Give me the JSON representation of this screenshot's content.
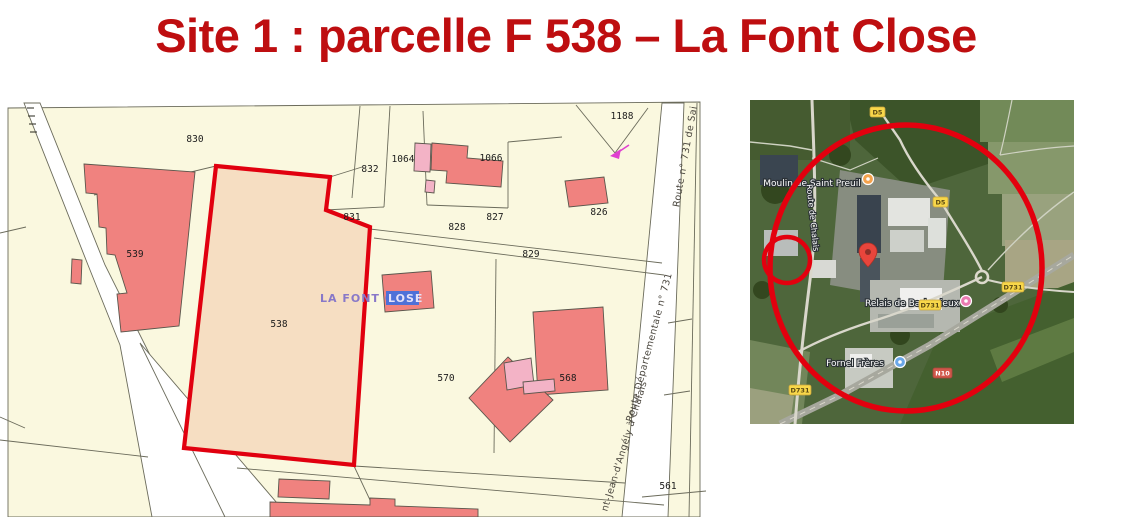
{
  "title": "Site 1 : parcelle F 538 – La Font Close",
  "cadastral_map": {
    "locality_label_part1": "LA FONT C",
    "locality_label_part2": "LOSE",
    "parcel_numbers": {
      "p830": "830",
      "p832": "832",
      "p1064": "1064",
      "p1066": "1066",
      "p1188": "1188",
      "p827": "827",
      "p828": "828",
      "p829": "829",
      "p826": "826",
      "p831": "831",
      "p539": "539",
      "p538": "538",
      "p570": "570",
      "p568": "568",
      "p561": "561"
    },
    "road_names": {
      "route_731_top": "Route n° 731 de Sai",
      "route_departementale": "Route Départementale n° 731",
      "route_jean_angely": "nt-Jean-d'Angély à Chalais"
    },
    "colors": {
      "map_background": "#FAF8DF",
      "building_fill": "#F0827F",
      "building_light_fill": "#F3B3C6",
      "highlight_parcel_fill": "#F6DEC2",
      "highlight_parcel_border": "#E1000F",
      "parcel_line": "#6B6B5B"
    }
  },
  "satellite_map": {
    "place_labels": {
      "moulin": "Moulin de Saint Preuil",
      "relais": "Relais de Barbezieux",
      "fornel": "Fornel Frères",
      "route_chalais": "Route de Chalais"
    },
    "route_badges": {
      "d5_top": "D5",
      "d5_mid": "D5",
      "d731_right": "D731",
      "d731_mid": "D731",
      "d731_left": "D731",
      "n10": "N10"
    },
    "colors": {
      "annotation_red": "#E3000E",
      "badge_yellow": "#F8D74A",
      "pin_red": "#E8453C"
    }
  }
}
